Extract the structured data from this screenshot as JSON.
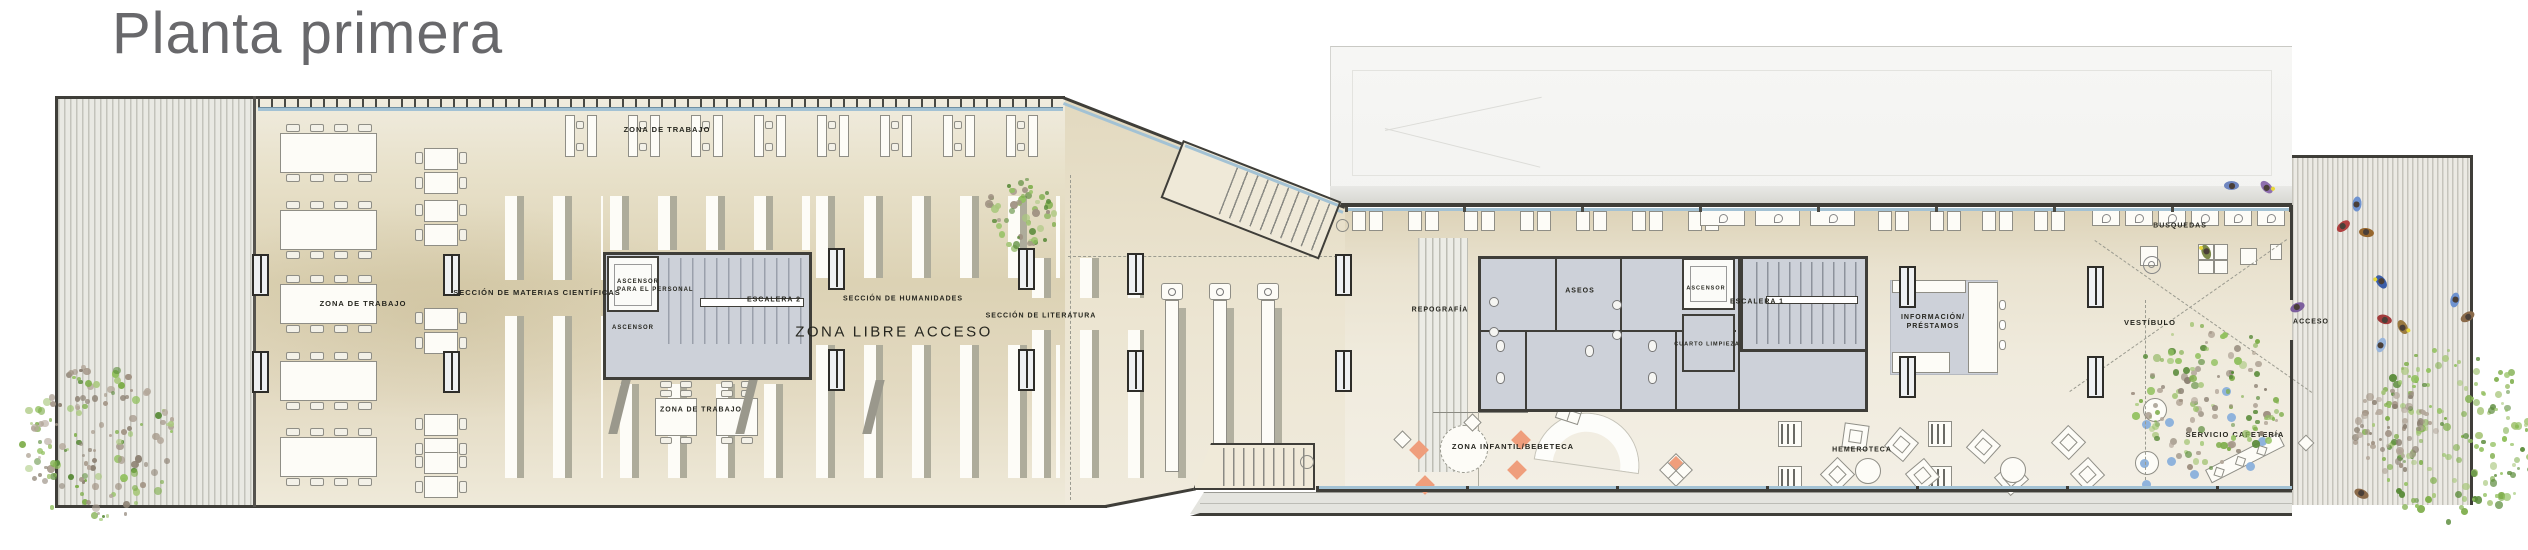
{
  "title": "Planta primera",
  "plan": {
    "labels": [
      {
        "id": "zona-trabajo-top",
        "text": "ZONA DE TRABAJO",
        "x": 667,
        "y": 130,
        "size": 7.5
      },
      {
        "id": "zona-trabajo-left",
        "text": "ZONA DE TRABAJO",
        "x": 363,
        "y": 304,
        "size": 7.5
      },
      {
        "id": "seccion-materias-cientificas",
        "text": "SECCIÓN DE MATERIAS CIENTÍFICAS",
        "x": 537,
        "y": 293,
        "size": 7.5
      },
      {
        "id": "ascensor-para-el-personal",
        "text": "ASCENSOR\nPARA EL PERSONAL",
        "x": 617,
        "y": 287,
        "size": 6,
        "align": "left"
      },
      {
        "id": "ascensor-izquierdo",
        "text": "ASCENSOR",
        "x": 633,
        "y": 329,
        "size": 6
      },
      {
        "id": "escalera-2",
        "text": "ESCALERA 2",
        "x": 774,
        "y": 300,
        "size": 7
      },
      {
        "id": "seccion-humanidades",
        "text": "SECCIÓN DE HUMANIDADES",
        "x": 903,
        "y": 299,
        "size": 7
      },
      {
        "id": "zona-libre-acceso",
        "text": "ZONA LIBRE ACCESO",
        "x": 894,
        "y": 332,
        "size": 15,
        "big": true
      },
      {
        "id": "seccion-literatura",
        "text": "SECCIÓN DE LITERATURA",
        "x": 1041,
        "y": 316,
        "size": 7
      },
      {
        "id": "zona-trabajo-inferior",
        "text": "ZONA DE TRABAJO",
        "x": 701,
        "y": 410,
        "size": 7
      },
      {
        "id": "reprografia",
        "text": "REPOGRAFÍA",
        "x": 1440,
        "y": 310,
        "size": 7
      },
      {
        "id": "aseos",
        "text": "ASEOS",
        "x": 1580,
        "y": 291,
        "size": 7
      },
      {
        "id": "ascensor-derecho",
        "text": "ASCENSOR",
        "x": 1706,
        "y": 289,
        "size": 5.5
      },
      {
        "id": "escalera-1",
        "text": "ESCALERA 1",
        "x": 1757,
        "y": 302,
        "size": 7
      },
      {
        "id": "cuarto-limpieza",
        "text": "CUARTO LIMPIEZA",
        "x": 1707,
        "y": 345,
        "size": 5.5
      },
      {
        "id": "informacion-prestamos",
        "text": "INFORMACIÓN/\nPRÉSTAMOS",
        "x": 1933,
        "y": 322,
        "size": 7
      },
      {
        "id": "busquedas",
        "text": "BUSQUEDAS",
        "x": 2180,
        "y": 226,
        "size": 7
      },
      {
        "id": "vestibulo",
        "text": "VESTÍBULO",
        "x": 2150,
        "y": 323,
        "size": 7.5
      },
      {
        "id": "acceso",
        "text": "ACCESO",
        "x": 2311,
        "y": 322,
        "size": 7
      },
      {
        "id": "zona-infantil",
        "text": "ZONA INFANTIL/BEBETECA",
        "x": 1513,
        "y": 447,
        "size": 7.5
      },
      {
        "id": "hemeroteca",
        "text": "HEMEROTECA",
        "x": 1862,
        "y": 450,
        "size": 7
      },
      {
        "id": "servicio-cafeteria",
        "text": "SERVICIO CAFETERÍA",
        "x": 2235,
        "y": 435,
        "size": 7.5
      }
    ],
    "colors": {
      "title_gray": "#68686b",
      "wall": "#3f3e39",
      "wall_light": "#8a8a82",
      "floor_light": "#f1ecdd",
      "floor_mid": "#e6dec6",
      "floor_dark": "#d7cca9",
      "core_fill": "#cdd1d9",
      "glazing_blue": "#a3c2d4",
      "stack_shadow": "#aeac9b",
      "stripe_line": "#c3c3bb",
      "stripe_bg": "#e9e9e3",
      "roof_light": "#f3f3f1",
      "roof_edge": "#d6d6d1",
      "label_ink": "#26261f",
      "orange": "#ef9e7c",
      "chair_blue": "#8fb3dc",
      "furniture_white": "#fdfcf7",
      "furniture_line": "#8f8e86",
      "tree_greens": [
        "#7fae4c",
        "#93c161",
        "#5c8c3c",
        "#aac87e"
      ],
      "tree_grays": [
        "#a19384",
        "#8d8274",
        "#b3a79a"
      ],
      "people": [
        "#6f86c0",
        "#8e6fae",
        "#6f93d0",
        "#b04040",
        "#97672e",
        "#3c5ea8",
        "#a23c3c",
        "#9a7a40",
        "#9ab6dc",
        "#7d5f9e",
        "#8a6a4a",
        "#7d8a4a"
      ]
    }
  }
}
